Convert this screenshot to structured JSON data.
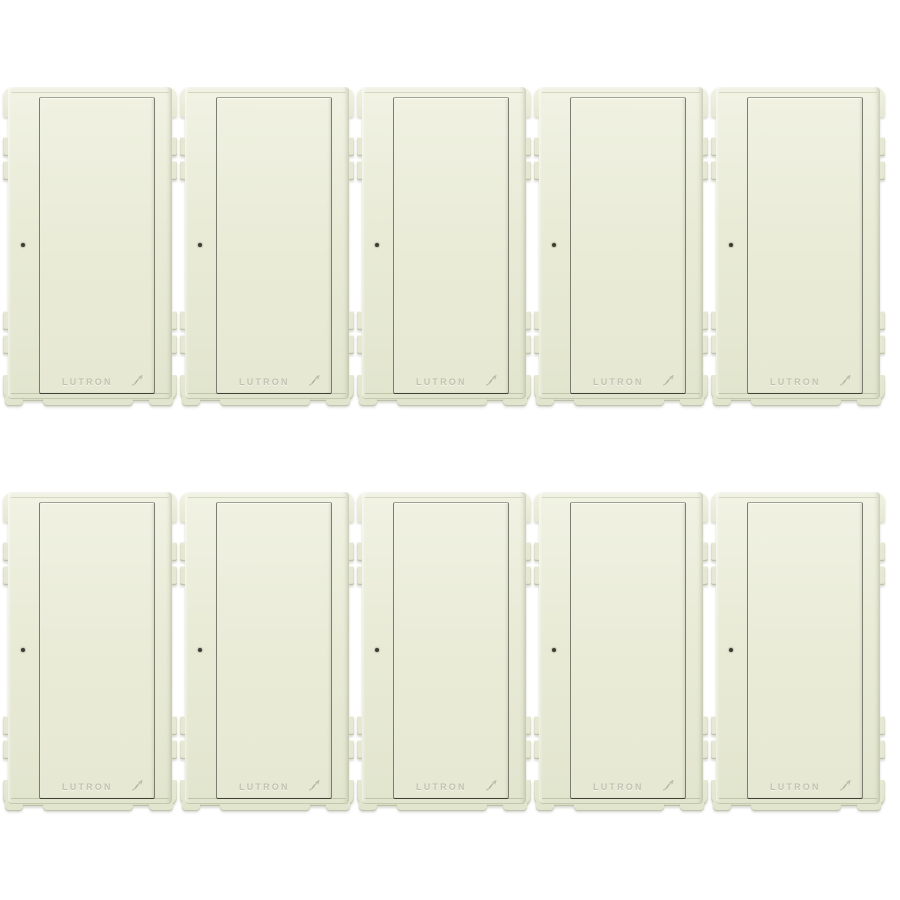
{
  "image": {
    "background_color": "#ffffff"
  },
  "product": {
    "brand_label": "LUTRON",
    "unit_count": 10,
    "grid": {
      "rows": 2,
      "columns": 5
    },
    "finish": {
      "name": "biscuit",
      "colors": {
        "body": "#e9ebd7",
        "body-light": "#f1f2e3",
        "body-dark": "#e2e5ce",
        "frame": "#e6e8d3",
        "edge-line": "#c3c7ab",
        "paddle-top": "#f0f1e1",
        "paddle-bottom": "#e6e8d4",
        "border-top": "#a2a493",
        "border-side": "#7b7d70",
        "border-bottom": "#3f4136",
        "led-dot": "#3b3d34",
        "emboss": "rgba(128,132,104,0.42)"
      }
    }
  }
}
